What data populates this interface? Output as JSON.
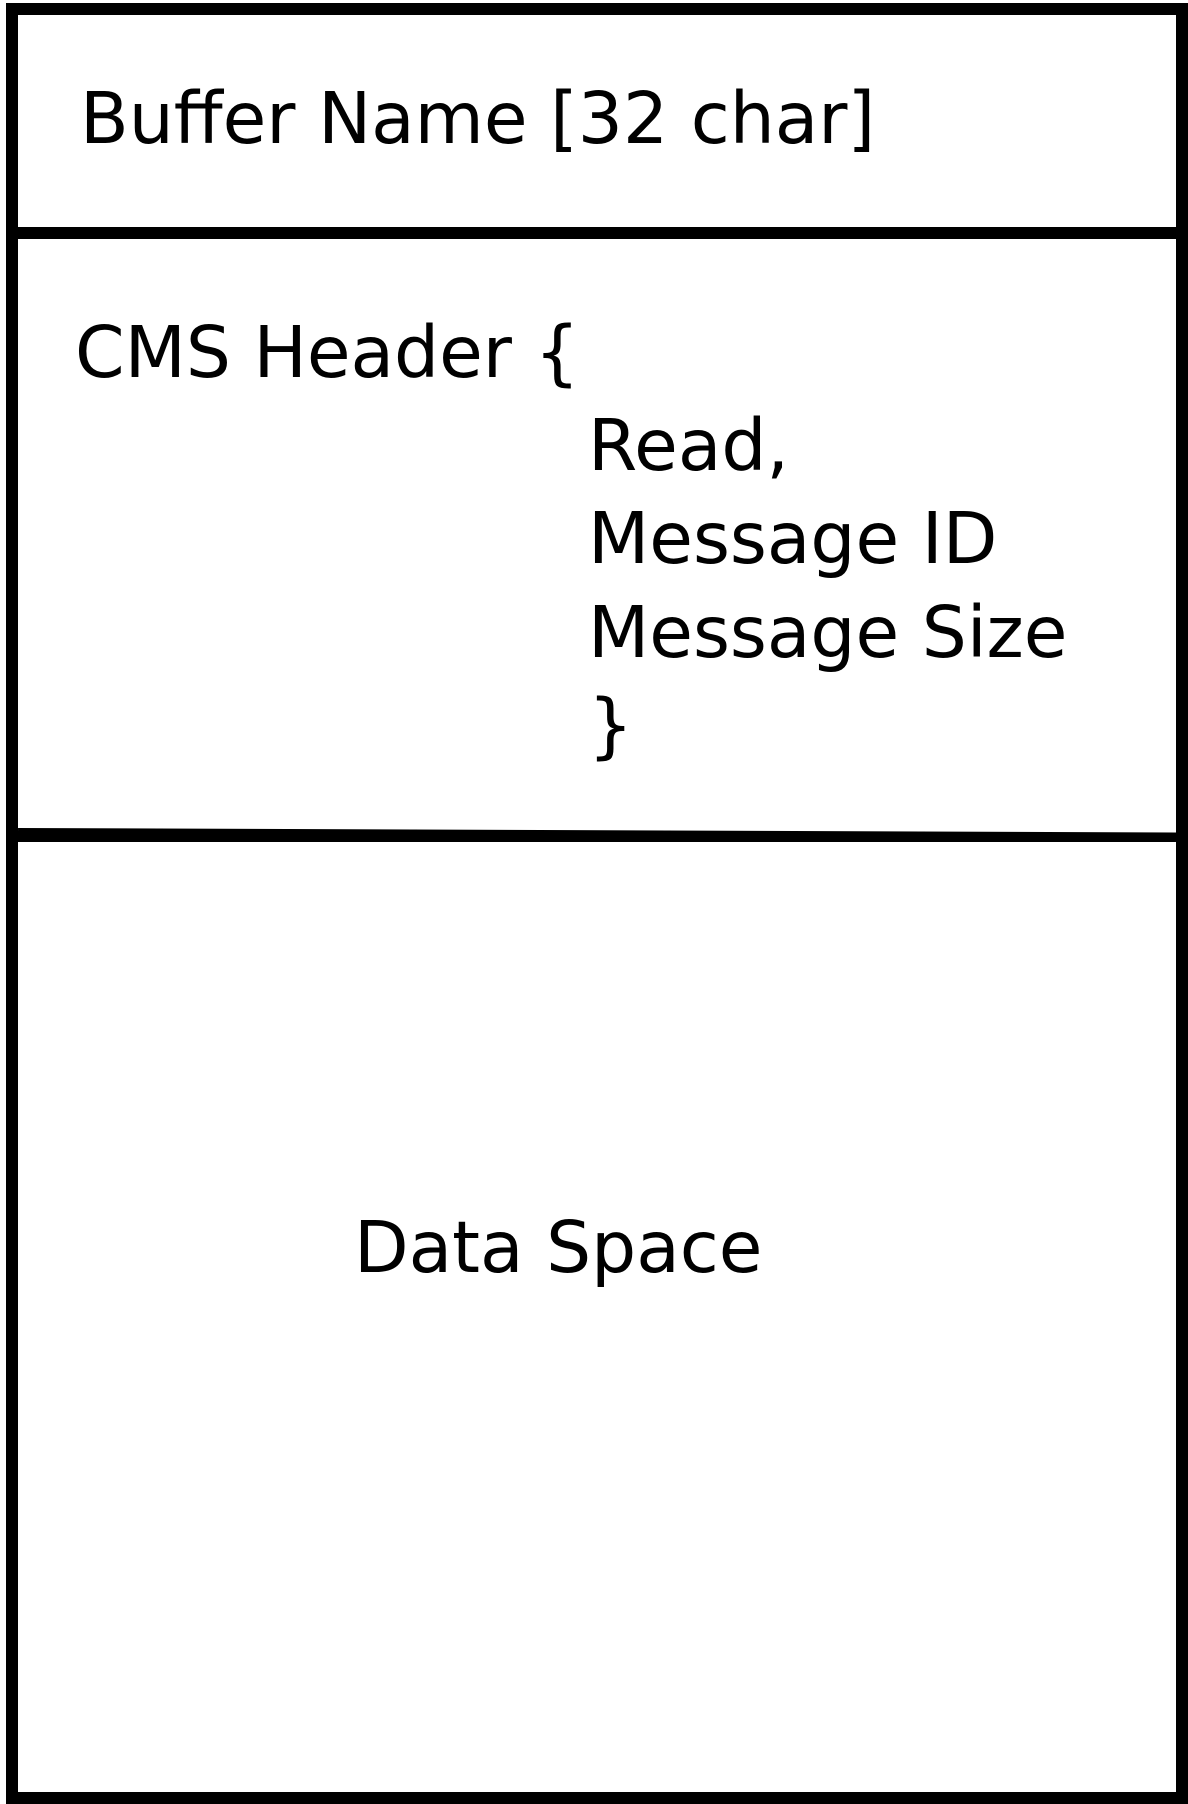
{
  "diagram": {
    "colors": {
      "stroke": "#000000",
      "background": "#ffffff"
    },
    "buffer_name_section": {
      "label": "Buffer Name [32 char]"
    },
    "cms_header_section": {
      "open": "CMS Header {",
      "fields": [
        "Read,",
        "Message ID",
        "Message Size"
      ],
      "close": "}"
    },
    "data_section": {
      "label": "Data Space"
    }
  }
}
